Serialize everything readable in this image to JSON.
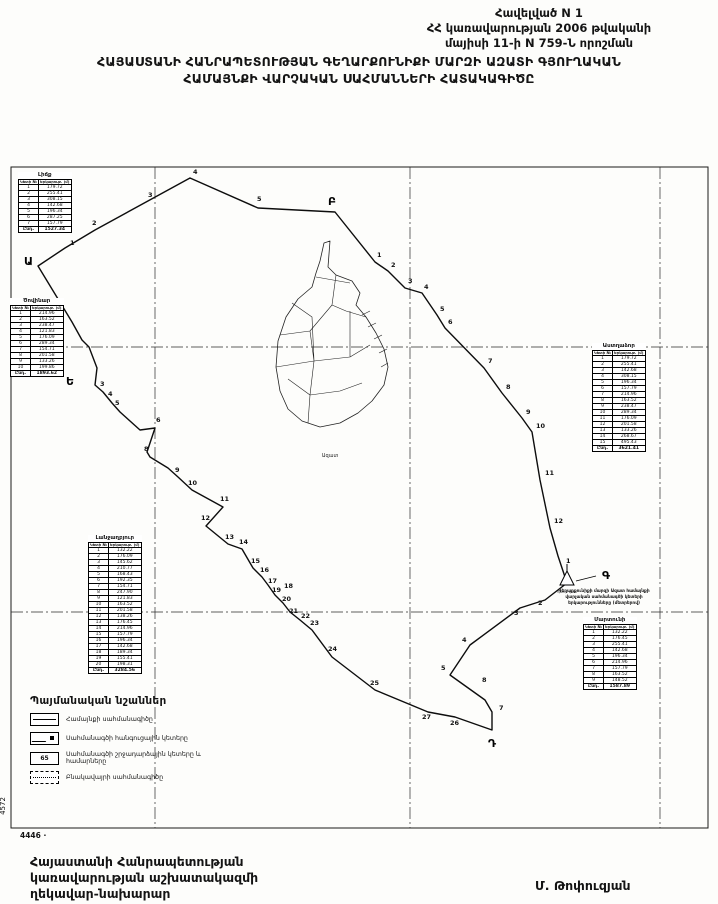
{
  "header": {
    "line1": "Հավելված N 1",
    "line2": "ՀՀ կառավարության 2006 թվականի",
    "line3": "մայիսի 11-ի N 759-Ն որոշման"
  },
  "title": {
    "line1": "ՀԱՅԱՍՏԱՆԻ ՀԱՆՐԱՊԵՏՈՒԹՅԱՆ ԳԵՂԱՐՔՈՒՆԻՔԻ ՄԱՐԶԻ ԱԶԱՏԻ ԳՅՈՒՂԱԿԱՆ",
    "line2": "ՀԱՄԱՅՆՔԻ ՎԱՐՉԱԿԱՆ  ՍԱՀՄԱՆՆԵՐԻ ՀԱՏԱԿԱԳԻԾԸ"
  },
  "map": {
    "settlement_label": "Ազատ",
    "geodetic_label": "գեոդ. կետ",
    "sheet_number_bottom": "4446 ·",
    "sheet_number_left": "4572",
    "corner_letters": [
      {
        "ch": "Ա",
        "x": 14,
        "y": 100
      },
      {
        "ch": "Բ",
        "x": 318,
        "y": 40
      },
      {
        "ch": "Գ",
        "x": 592,
        "y": 414
      },
      {
        "ch": "Դ",
        "x": 478,
        "y": 582
      },
      {
        "ch": "Ե",
        "x": 56,
        "y": 220
      }
    ],
    "boundary_points": [
      {
        "n": "1",
        "x": 60,
        "y": 80
      },
      {
        "n": "2",
        "x": 82,
        "y": 60
      },
      {
        "n": "3",
        "x": 138,
        "y": 32
      },
      {
        "n": "4",
        "x": 183,
        "y": 9
      },
      {
        "n": "5",
        "x": 247,
        "y": 36
      },
      {
        "n": "1",
        "x": 367,
        "y": 92
      },
      {
        "n": "2",
        "x": 381,
        "y": 102
      },
      {
        "n": "3",
        "x": 398,
        "y": 118
      },
      {
        "n": "4",
        "x": 414,
        "y": 124
      },
      {
        "n": "5",
        "x": 430,
        "y": 146
      },
      {
        "n": "6",
        "x": 438,
        "y": 159
      },
      {
        "n": "7",
        "x": 478,
        "y": 198
      },
      {
        "n": "8",
        "x": 496,
        "y": 224
      },
      {
        "n": "9",
        "x": 516,
        "y": 249
      },
      {
        "n": "10",
        "x": 526,
        "y": 263
      },
      {
        "n": "11",
        "x": 535,
        "y": 310
      },
      {
        "n": "12",
        "x": 544,
        "y": 358
      },
      {
        "n": "1",
        "x": 556,
        "y": 398
      },
      {
        "n": "2",
        "x": 528,
        "y": 440
      },
      {
        "n": "3",
        "x": 504,
        "y": 450
      },
      {
        "n": "4",
        "x": 452,
        "y": 477
      },
      {
        "n": "5",
        "x": 431,
        "y": 505
      },
      {
        "n": "8",
        "x": 472,
        "y": 517
      },
      {
        "n": "7",
        "x": 489,
        "y": 545
      },
      {
        "n": "26",
        "x": 440,
        "y": 560
      },
      {
        "n": "27",
        "x": 412,
        "y": 554
      },
      {
        "n": "25",
        "x": 360,
        "y": 520
      },
      {
        "n": "24",
        "x": 318,
        "y": 486
      },
      {
        "n": "23",
        "x": 300,
        "y": 460
      },
      {
        "n": "22",
        "x": 291,
        "y": 453
      },
      {
        "n": "21",
        "x": 279,
        "y": 448
      },
      {
        "n": "20",
        "x": 272,
        "y": 436
      },
      {
        "n": "19",
        "x": 262,
        "y": 427
      },
      {
        "n": "18",
        "x": 274,
        "y": 423
      },
      {
        "n": "17",
        "x": 258,
        "y": 418
      },
      {
        "n": "16",
        "x": 250,
        "y": 407
      },
      {
        "n": "15",
        "x": 241,
        "y": 398
      },
      {
        "n": "14",
        "x": 229,
        "y": 379
      },
      {
        "n": "13",
        "x": 215,
        "y": 374
      },
      {
        "n": "12",
        "x": 191,
        "y": 355
      },
      {
        "n": "11",
        "x": 210,
        "y": 336
      },
      {
        "n": "10",
        "x": 178,
        "y": 320
      },
      {
        "n": "9",
        "x": 165,
        "y": 307
      },
      {
        "n": "8",
        "x": 134,
        "y": 286
      },
      {
        "n": "6",
        "x": 146,
        "y": 257
      },
      {
        "n": "5",
        "x": 105,
        "y": 240
      },
      {
        "n": "4",
        "x": 98,
        "y": 231
      },
      {
        "n": "3",
        "x": 90,
        "y": 221
      }
    ]
  },
  "tables": {
    "topleft": {
      "title": "Լիճք",
      "col1": "Կետի №",
      "col2": "Երկարութ. (մ)",
      "rows": [
        [
          "1",
          "179.72"
        ],
        [
          "2",
          "255.41"
        ],
        [
          "3",
          "308.15"
        ],
        [
          "4",
          "142.68"
        ],
        [
          "5",
          "196.34"
        ],
        [
          "6",
          "287.25"
        ],
        [
          "7",
          "157.79"
        ]
      ],
      "total_label": "Ընդ.",
      "total": "1527.34"
    },
    "left": {
      "title": "Ծովինար",
      "col1": "Կետի №",
      "col2": "Երկարութ. (մ)",
      "rows": [
        [
          "1",
          "214.96"
        ],
        [
          "2",
          "163.52"
        ],
        [
          "3",
          "238.47"
        ],
        [
          "4",
          "121.83"
        ],
        [
          "5",
          "176.09"
        ],
        [
          "6",
          "289.34"
        ],
        [
          "7",
          "154.71"
        ],
        [
          "8",
          "201.58"
        ],
        [
          "9",
          "133.26"
        ],
        [
          "10",
          "199.86"
        ]
      ],
      "total_label": "Ընդ.",
      "total": "1893.62"
    },
    "right": {
      "title": "Աստղաձոր",
      "col1": "Կետի №",
      "col2": "Երկարութ. (մ)",
      "rows": [
        [
          "1",
          "179.72"
        ],
        [
          "2",
          "255.41"
        ],
        [
          "3",
          "142.68"
        ],
        [
          "4",
          "308.15"
        ],
        [
          "5",
          "196.34"
        ],
        [
          "6",
          "157.79"
        ],
        [
          "7",
          "214.96"
        ],
        [
          "8",
          "163.52"
        ],
        [
          "9",
          "238.47"
        ],
        [
          "10",
          "289.34"
        ],
        [
          "11",
          "176.09"
        ],
        [
          "12",
          "201.58"
        ],
        [
          "13",
          "133.26"
        ],
        [
          "14",
          "268.67"
        ],
        [
          "15",
          "495.43"
        ]
      ],
      "total_label": "Ընդ.",
      "total": "3621.41"
    },
    "bottomcenter": {
      "title": "Լանջաղբյուր",
      "col1": "Կետի №",
      "col2": "Երկարութ. (մ)",
      "rows": [
        [
          "1",
          "132.22"
        ],
        [
          "2",
          "176.09"
        ],
        [
          "3",
          "145.62"
        ],
        [
          "4",
          "210.77"
        ],
        [
          "5",
          "168.43"
        ],
        [
          "6",
          "192.35"
        ],
        [
          "7",
          "154.71"
        ],
        [
          "8",
          "247.90"
        ],
        [
          "9",
          "121.83"
        ],
        [
          "10",
          "163.52"
        ],
        [
          "11",
          "201.58"
        ],
        [
          "12",
          "138.26"
        ],
        [
          "13",
          "176.45"
        ],
        [
          "14",
          "214.96"
        ],
        [
          "15",
          "157.79"
        ],
        [
          "16",
          "196.34"
        ],
        [
          "17",
          "142.68"
        ],
        [
          "18",
          "189.34"
        ],
        [
          "19",
          "155.41"
        ],
        [
          "20",
          "198.31"
        ]
      ],
      "total_label": "Ընդ.",
      "total": "3284.56"
    },
    "bottomright": {
      "title": "Մարտունի",
      "col1": "Կետի №",
      "col2": "Երկարութ. (մ)",
      "rows": [
        [
          "1",
          "132.22"
        ],
        [
          "2",
          "176.45"
        ],
        [
          "3",
          "255.41"
        ],
        [
          "4",
          "142.68"
        ],
        [
          "5",
          "196.34"
        ],
        [
          "6",
          "214.96"
        ],
        [
          "7",
          "157.79"
        ],
        [
          "8",
          "163.52"
        ],
        [
          "9",
          "148.52"
        ]
      ],
      "total_label": "Ընդ.",
      "total": "1587.89"
    }
  },
  "note": {
    "line1": "Գեղարքունիքի մարզի Ազատ համայնքի",
    "line2": "վարչական սահմանագծի կետերի",
    "line3": "երկարությունները (մետրերով)"
  },
  "legend": {
    "title": "Պայմանական նշաններ",
    "items": [
      {
        "symbol": "line",
        "label": "Համայնքի սահմանագիծը"
      },
      {
        "symbol": "node",
        "label": "Սահմանագծի հանգուցային կետերը"
      },
      {
        "symbol": "number",
        "label": "Սահմանագծի շրջադարձային կետերը և համարները",
        "sample": "65"
      },
      {
        "symbol": "dashed",
        "label": "Բնակավայրի սահմանագիծը"
      }
    ]
  },
  "footer": {
    "line1": "Հայաստանի Հանրապետության",
    "line2": "կառավարության աշխատակազմի",
    "line3": "ղեկավար-նախարար",
    "signature": "Մ. Թոփուզյան"
  }
}
